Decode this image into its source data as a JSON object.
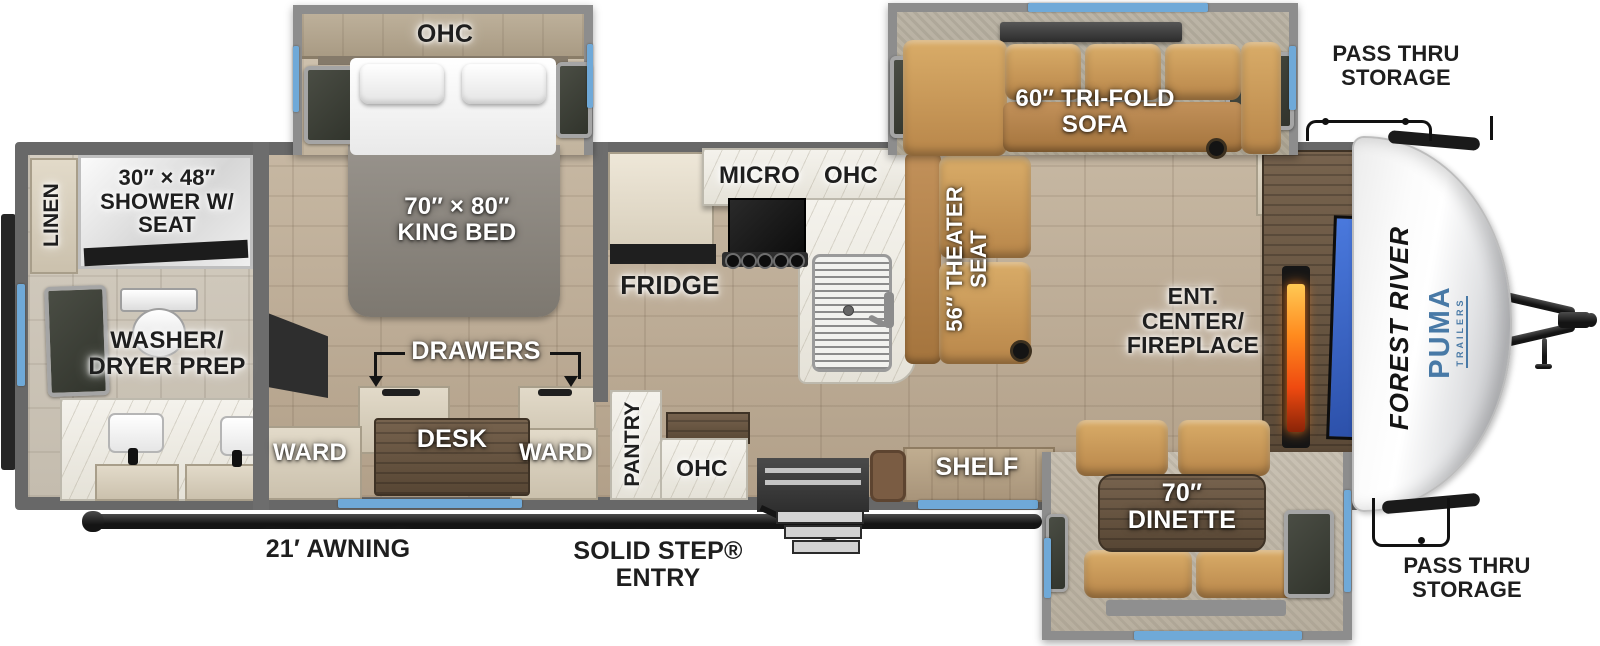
{
  "floorplan": {
    "brand": {
      "manufacturer": "FOREST RIVER",
      "model": "PUMA",
      "model_sub": "TRAILERS"
    },
    "colors": {
      "window_blue": "#6fa9d8",
      "upholstery_tan": "#c99a5c",
      "wall_gray": "#8d8d8d",
      "floor_wood": "#bcab93",
      "flame_orange": "#ff7a1a",
      "brand_blue": "#4879a6",
      "label_dark": "#1e1e1e",
      "label_light": "#ffffff"
    },
    "rear_bath": {
      "linen": "LINEN",
      "shower": "30″ × 48″ SHOWER W/ SEAT",
      "washer_dryer": "WASHER/ DRYER PREP"
    },
    "bedroom": {
      "ohc": "OHC",
      "king_bed": "70″ × 80″ KING BED",
      "drawers": "DRAWERS",
      "desk": "DESK",
      "ward_left": "WARD",
      "ward_right": "WARD"
    },
    "kitchen": {
      "fridge": "FRIDGE",
      "micro": "MICRO",
      "ohc_upper": "OHC",
      "pantry": "PANTRY",
      "ohc_lower": "OHC"
    },
    "living": {
      "trifold_sofa": "60″ TRI-FOLD SOFA",
      "theater_seat": "56″ THEATER SEAT",
      "ent_center": "ENT. CENTER/ FIREPLACE",
      "shelf": "SHELF",
      "dinette": "70″ DINETTE"
    },
    "exterior": {
      "pass_thru_top": "PASS THRU STORAGE",
      "pass_thru_bottom": "PASS THRU STORAGE",
      "awning": "21′ AWNING",
      "entry": "SOLID STEP® ENTRY"
    }
  }
}
